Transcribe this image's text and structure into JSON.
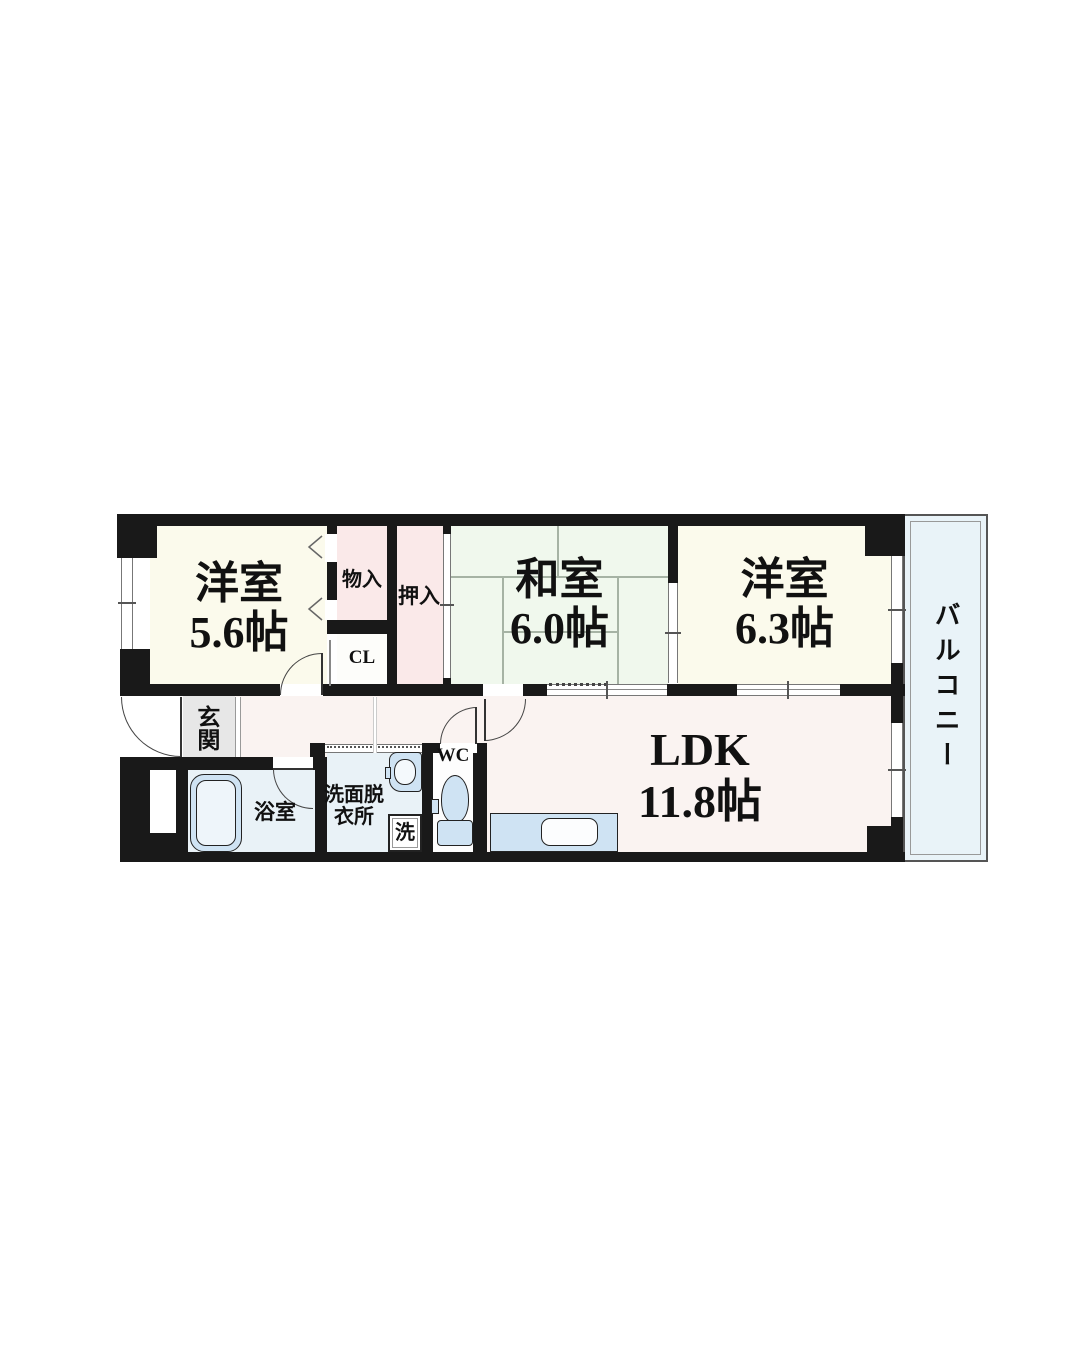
{
  "floor_plan": {
    "rooms": {
      "west_room_small": {
        "name": "洋室",
        "size": "5.6帖"
      },
      "japanese_room": {
        "name": "和室",
        "size": "6.0帖"
      },
      "west_room_large": {
        "name": "洋室",
        "size": "6.3帖"
      },
      "ldk": {
        "name": "LDK",
        "size": "11.8帖"
      },
      "balcony": {
        "name": "バルコニー"
      },
      "entrance": {
        "name": "玄関"
      },
      "bathroom": {
        "name": "浴室"
      },
      "washroom": {
        "line1": "洗面脱",
        "line2": "衣所"
      },
      "toilet": {
        "name": "WC"
      },
      "storage_monoire": {
        "name": "物入"
      },
      "closet": {
        "name": "CL"
      },
      "storage_oshiire": {
        "name": "押入"
      },
      "washing_machine": {
        "name": "洗"
      }
    },
    "colors": {
      "wall": "#191919",
      "western_room_fill": "#fbfaec",
      "tatami_fill": "#f0f8ed",
      "closet_fill": "#fae9e9",
      "ldk_fill": "#faf3f1",
      "balcony_fill": "#e9f3f8",
      "wet_area_fill": "#e9f2f7",
      "fixture_fill": "#cfe3f3",
      "entrance_tile_fill": "#e7e7e7"
    }
  }
}
